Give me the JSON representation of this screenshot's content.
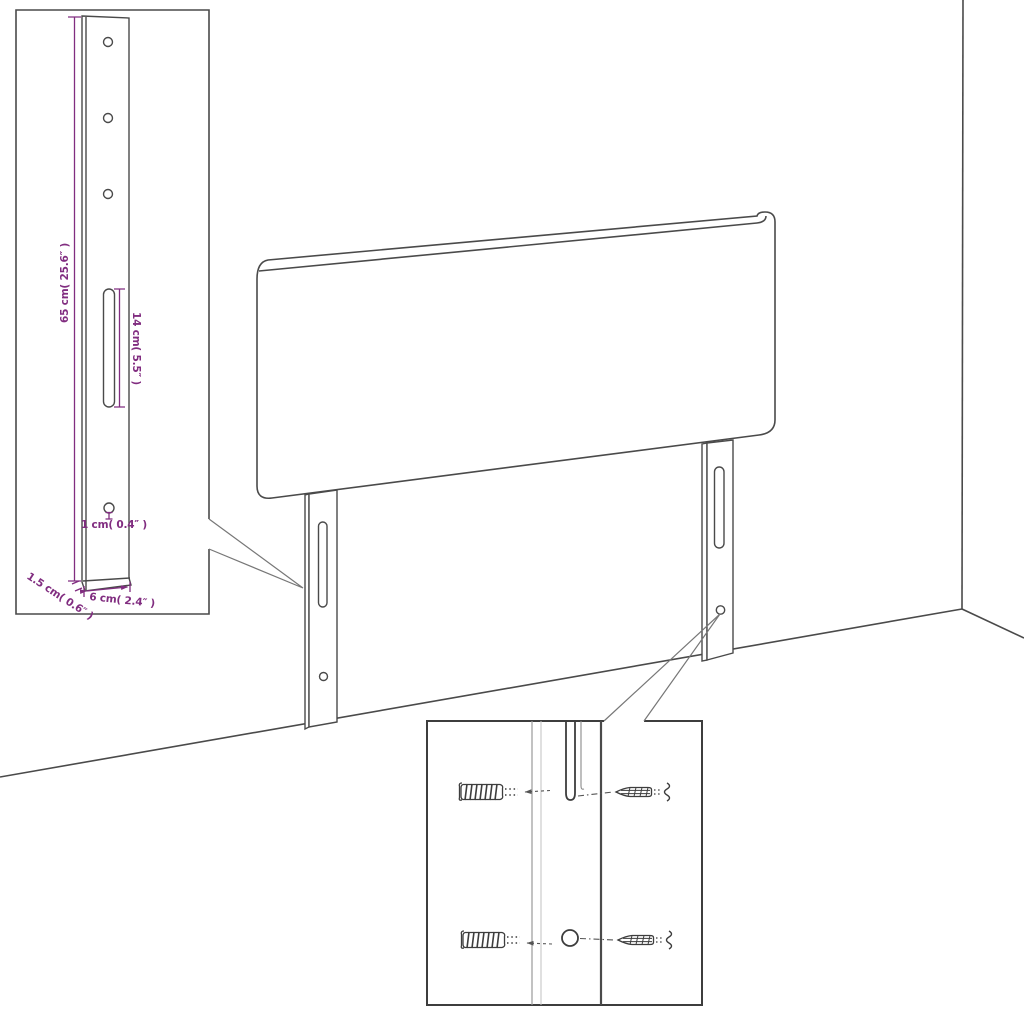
{
  "diagram": {
    "title": "headboard-assembly-dimension-diagram",
    "colors": {
      "line": "#4a4a4a",
      "line_dark": "#3d3d3d",
      "dimension": "#812d80",
      "background": "#ffffff"
    },
    "dimension_labels": {
      "leg_height": "65 cm( 25.6″ )",
      "slot_length": "14 cm( 5.5″ )",
      "hole_diameter": "1 cm( 0.4″ )",
      "leg_thickness": "1.5 cm( 0.6″ )",
      "leg_width": "6 cm( 2.4″ )"
    }
  }
}
